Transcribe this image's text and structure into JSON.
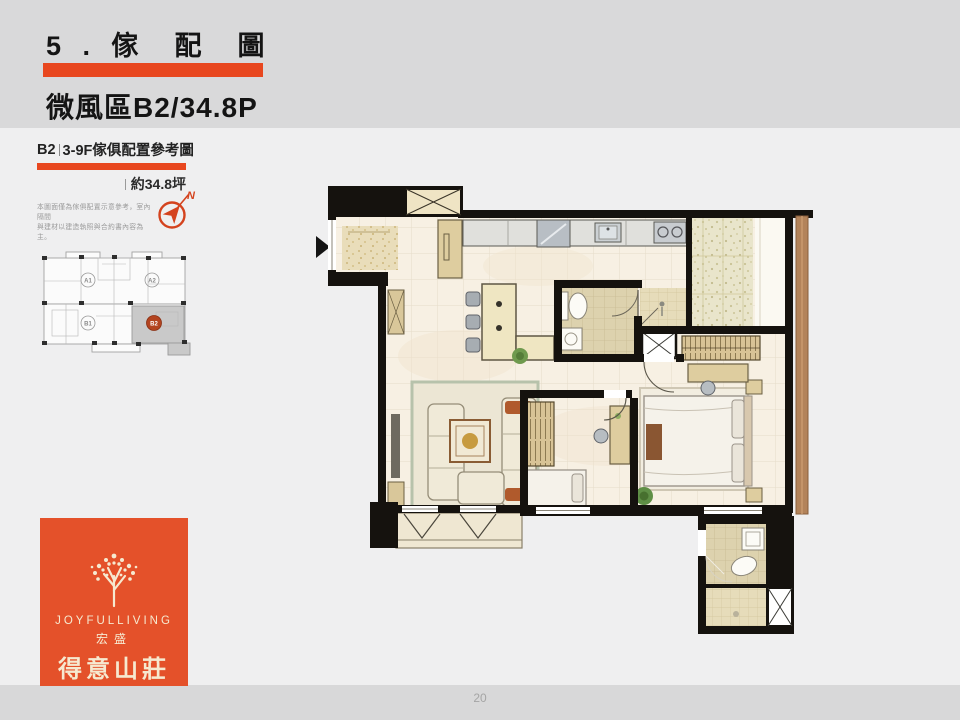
{
  "slide": {
    "title": "5 . 傢  配  圖",
    "subtitle": "微風區B2/34.8P",
    "page_number": "20",
    "accent_color": "#e8471f"
  },
  "sidebar": {
    "plan_header_unit": "B2",
    "plan_header_rest": "3-9F傢俱配置參考圖",
    "area_label": "約34.8坪",
    "disclaimer_line1": "本圖面僅為傢俱配置示意參考，室內隔間",
    "disclaimer_line2": "與建材以建造執照與合約書內容為主。",
    "compass_north_label": "N",
    "key_plan": {
      "unit_a1": "A1",
      "unit_a2": "A2",
      "unit_b1": "B1",
      "unit_b2": "B2",
      "highlight_color": "#c9c9c9",
      "badge_color": "#b34420"
    }
  },
  "logo": {
    "brand_en": "JOYFULLIVING",
    "brand_company": "宏盛",
    "brand_name": "得意山莊",
    "bg_color": "#e4512a",
    "icon": "tree-icon"
  }
}
